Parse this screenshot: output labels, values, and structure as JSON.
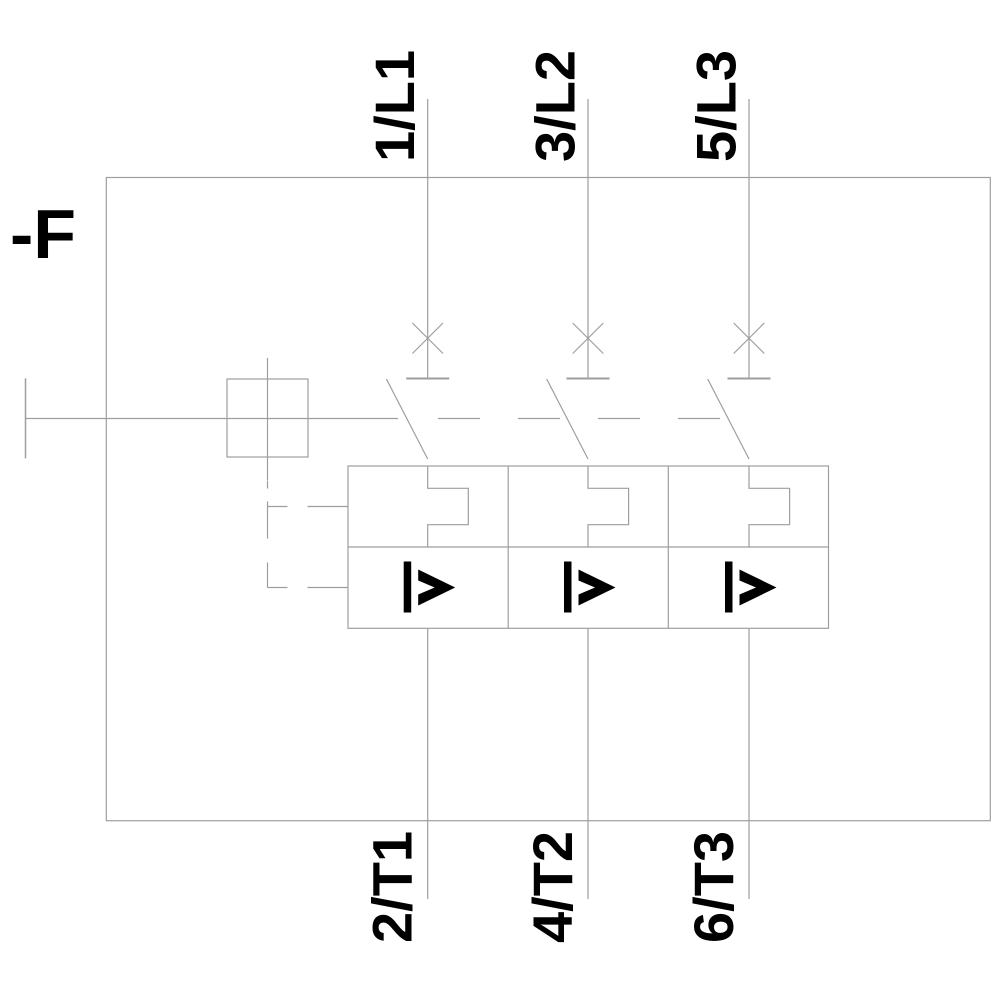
{
  "diagram": {
    "designator": "-F",
    "top_terminals": [
      "1/L1",
      "3/L2",
      "5/L3"
    ],
    "bottom_terminals": [
      "2/T1",
      "4/T2",
      "6/T3"
    ],
    "overcurrent_release_symbol": "I>",
    "icons": {
      "breaker_contact": "breaker-cross-icon",
      "thermal_overload": "thermal-overload-notch-icon",
      "overcurrent_release": "overcurrent-release-icon",
      "actuator": "actuator-box-icon",
      "mechanical_linkage": "dashed-linkage-icon"
    },
    "colors": {
      "line": "#9e9e9e",
      "text": "#000000",
      "background": "#ffffff"
    }
  }
}
